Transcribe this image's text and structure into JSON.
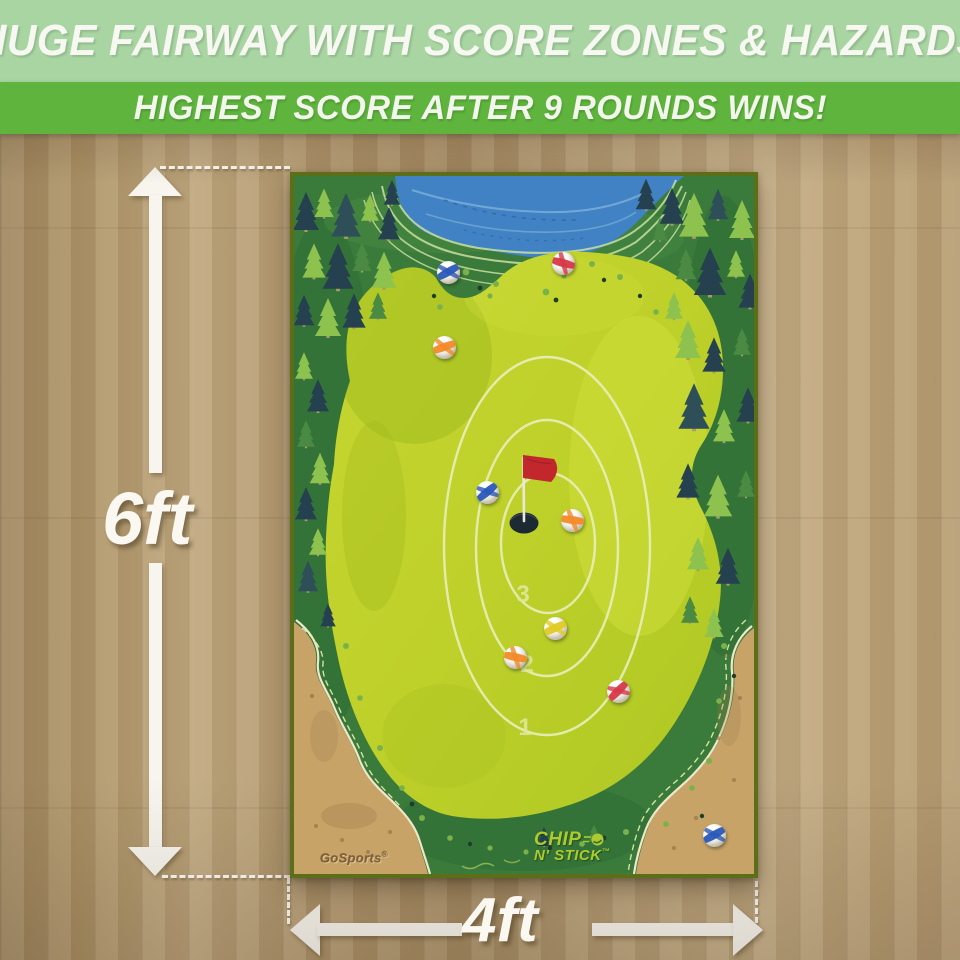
{
  "banners": {
    "headline": "HUGE FAIRWAY WITH SCORE ZONES & HAZARDS",
    "subheadline": "HIGHEST SCORE AFTER 9 ROUNDS WINS!",
    "headline_bg": "#a8d5a2",
    "subheadline_bg": "#5eb43c",
    "text_color": "#f6f8f1"
  },
  "dimensions": {
    "height_label": "6ft",
    "width_label": "4ft"
  },
  "mat": {
    "brand": "GoSports",
    "brand_reg": "®",
    "logo_line1": "CHIP",
    "logo_line2": "N' STICK",
    "logo_tm": "™",
    "zone_labels": [
      {
        "label": "3",
        "x": 229,
        "y": 419
      },
      {
        "label": "2",
        "x": 233,
        "y": 489
      },
      {
        "label": "1",
        "x": 231,
        "y": 552
      }
    ],
    "balls": [
      {
        "color": "blue",
        "hex": "#2a58b8",
        "x": 154,
        "y": 96,
        "rot": -30
      },
      {
        "color": "red",
        "hex": "#d63848",
        "x": 269,
        "y": 87,
        "rot": 15
      },
      {
        "color": "orange",
        "hex": "#f28a28",
        "x": 150,
        "y": 171,
        "rot": -20
      },
      {
        "color": "blue",
        "hex": "#2a58b8",
        "x": 193,
        "y": 316,
        "rot": -40
      },
      {
        "color": "orange",
        "hex": "#f28a28",
        "x": 278,
        "y": 344,
        "rot": 8
      },
      {
        "color": "yellow",
        "hex": "#e0ca24",
        "x": 261,
        "y": 452,
        "rot": -25
      },
      {
        "color": "orange",
        "hex": "#f28a28",
        "x": 221,
        "y": 481,
        "rot": 12
      },
      {
        "color": "red",
        "hex": "#d63848",
        "x": 324,
        "y": 515,
        "rot": -45
      },
      {
        "color": "blue",
        "hex": "#2a58b8",
        "x": 420,
        "y": 659,
        "rot": -30
      }
    ],
    "colors": {
      "fairway": "#c0d12b",
      "forest": "#3a7a3b",
      "water": "#4182c4",
      "sand": "#c7a368",
      "flag": "#c2272e",
      "border": "#5c6e17"
    }
  }
}
